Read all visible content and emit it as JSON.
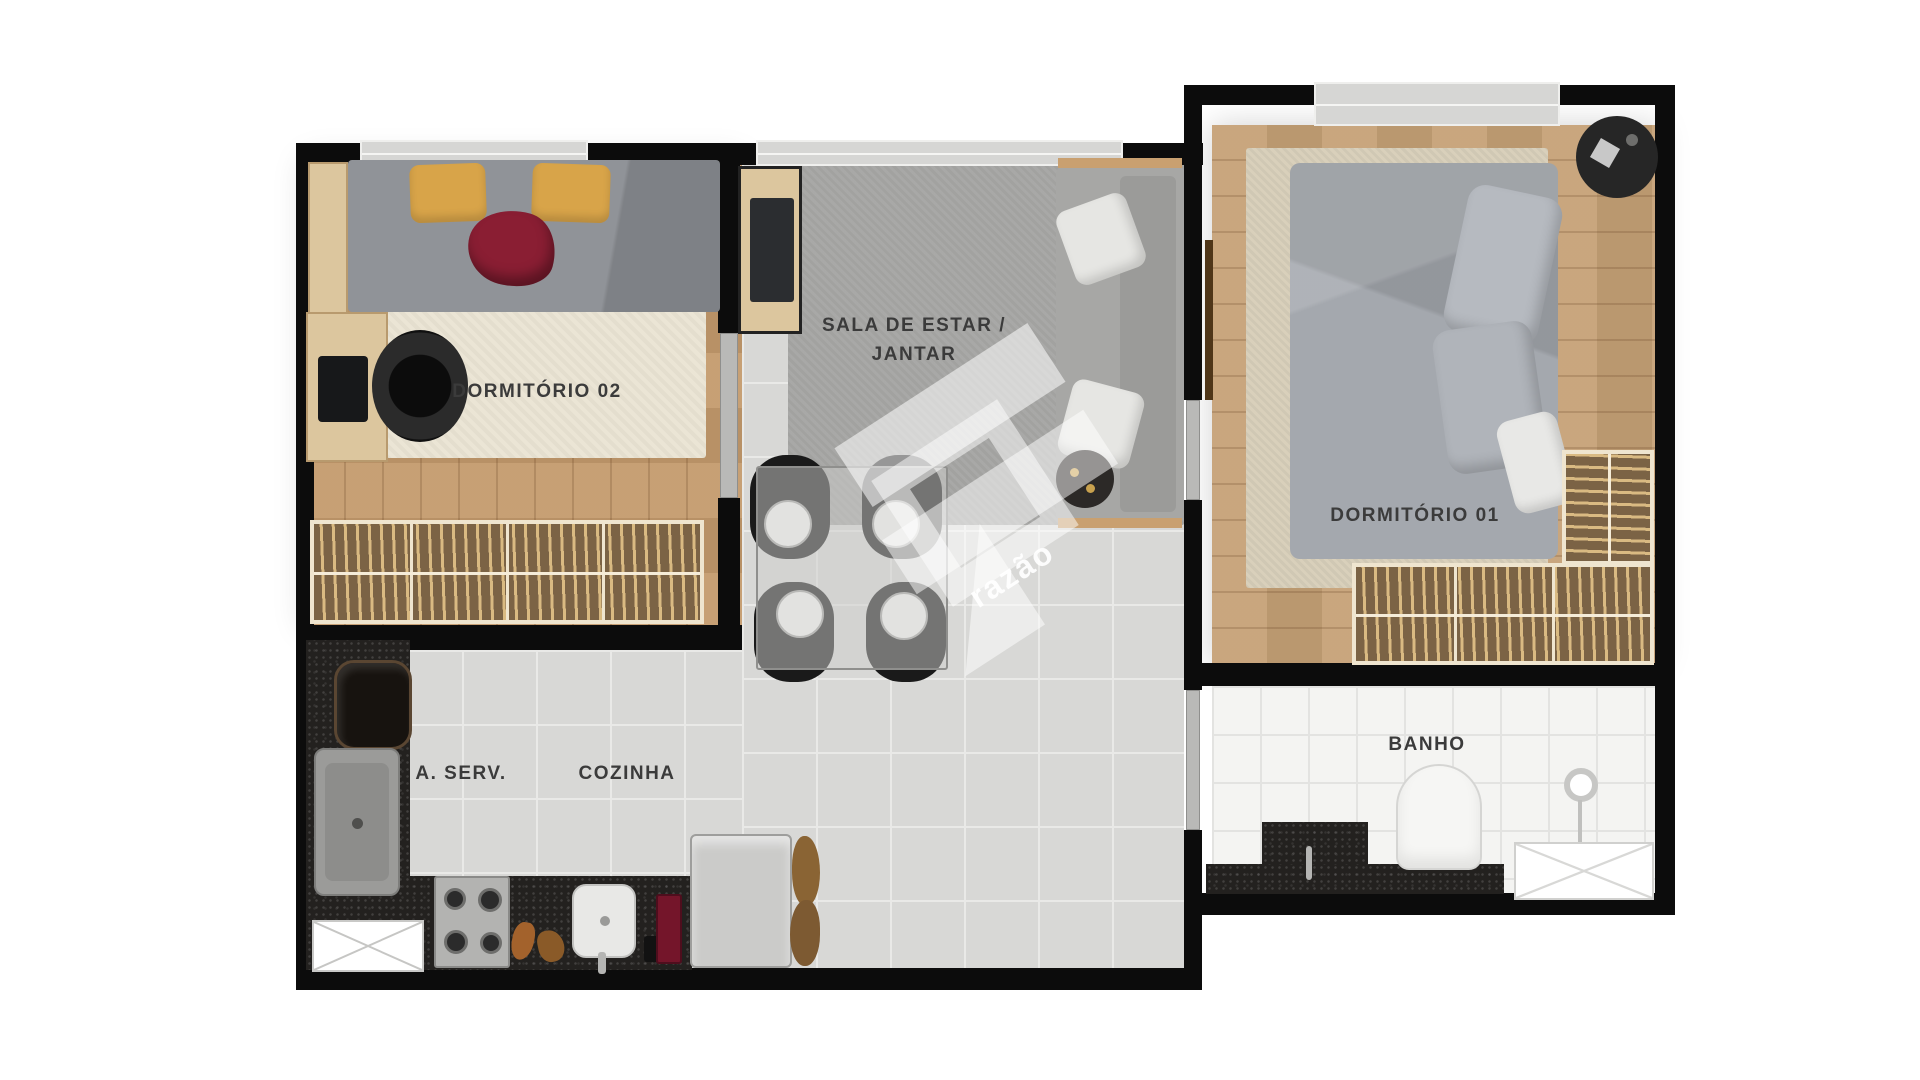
{
  "plan": {
    "title": "apartment-floor-plan"
  },
  "rooms": {
    "dormitorio02": {
      "label": "DORMITÓRIO 02"
    },
    "sala": {
      "label_line1": "SALA DE ESTAR /",
      "label_line2": "JANTAR"
    },
    "dormitorio01": {
      "label": "DORMITÓRIO 01"
    },
    "banho": {
      "label": "BANHO"
    },
    "area_servico": {
      "label": "A. SERV."
    },
    "cozinha": {
      "label": "COZINHA"
    }
  },
  "watermark": {
    "text": "razão"
  },
  "palette": {
    "wall": "#0c0c0c",
    "wood_floor": "#c49a6c",
    "gray_tile": "#d8d8d6",
    "bath_tile": "#f4f4f2",
    "granite_counter": "#23211f",
    "closet_wood": "#7b6345",
    "pillow_yellow": "#d8a449",
    "blanket_red": "#8a1e33",
    "sofa_gray": "#a7a7a5",
    "label_text": "#3b3b3b"
  }
}
